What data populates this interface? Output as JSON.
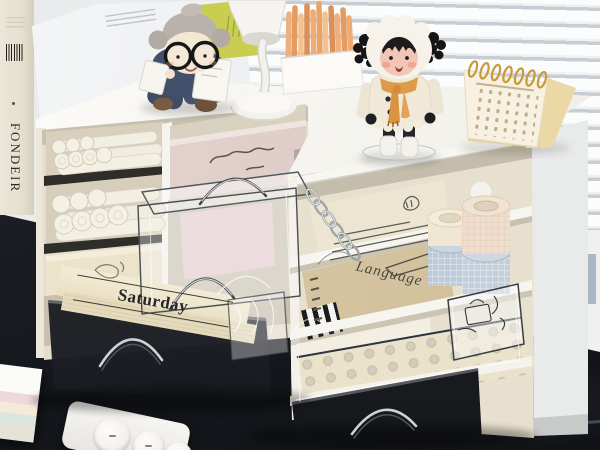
{
  "scene": {
    "type": "photograph",
    "setting": "Two white desktop drawer organizers filled with stationery on a dark desk in front of white window blinds, decorated with a grandma doll, a girl doll, a white desk lamp, orange pencils and a cream desk calendar"
  },
  "labels": {
    "book_spine_title": "FONDEIR",
    "notepad_day": "Saturday",
    "notebook_subject": "Language"
  },
  "palette": {
    "wall": "#e9ebed",
    "blind_slat": "#fbfcfc",
    "blind_gap": "#c7cdd2",
    "desk": "#191c22",
    "organizer_white": "#f7f5f1",
    "interior_cream": "#e8e0cf",
    "pink_drawer": "#ddc9c5",
    "pink_pad": "#ecd2d5",
    "chartreuse_card": "#c9ce51",
    "pencil_orange": "#e8a36b",
    "scarf_orange": "#dd9a48",
    "washi_blue": "#bdcad7",
    "washi_cream": "#f0e4d4",
    "calendar_cream": "#f3e2b9",
    "smoke_drawer": "#202329",
    "marker_white": "#f2eee2"
  }
}
